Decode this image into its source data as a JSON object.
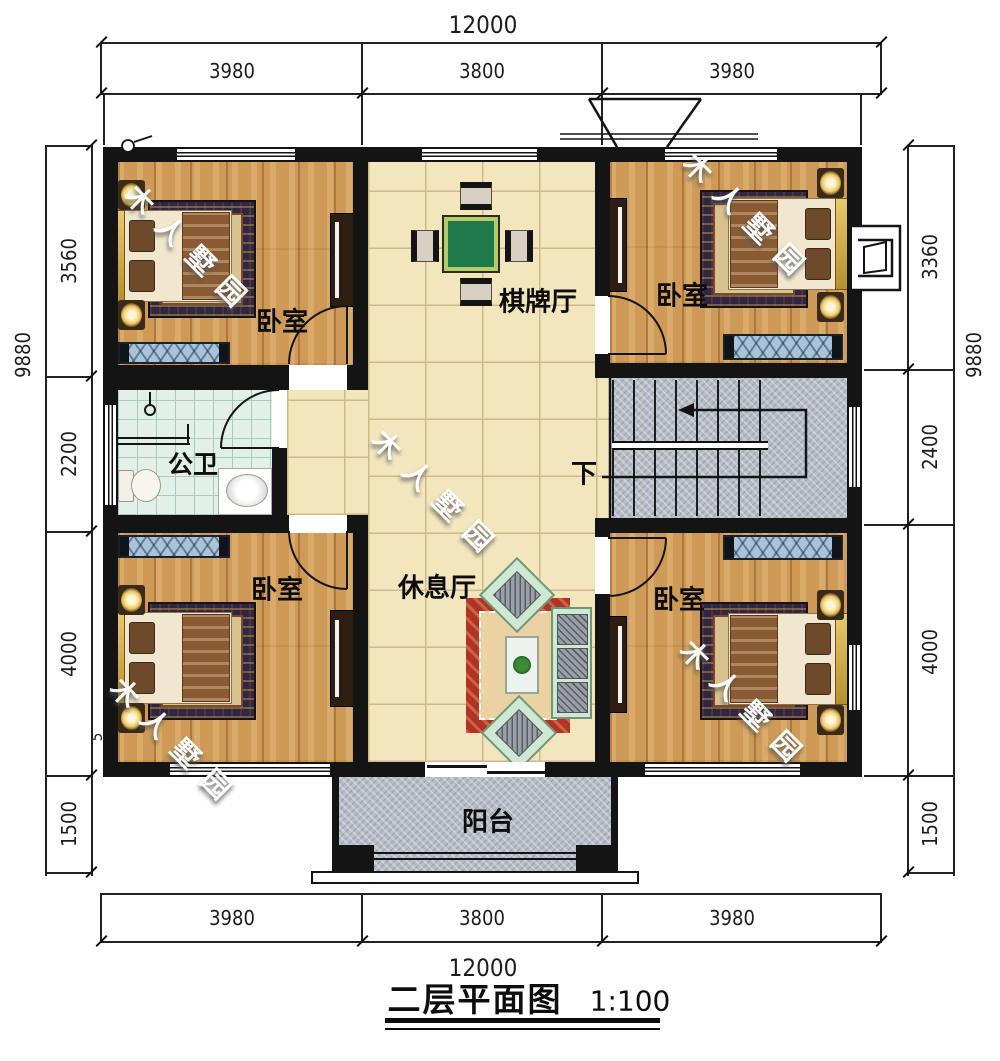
{
  "title": {
    "text": "二层平面图",
    "scale": "1:100"
  },
  "dimensions": {
    "top": {
      "total": "12000",
      "segments": [
        "3980",
        "3800",
        "3980"
      ]
    },
    "bottom": {
      "total": "12000",
      "segments": [
        "3980",
        "3800",
        "3980"
      ]
    },
    "left": {
      "total": "9880",
      "segments": [
        "3560",
        "2200",
        "4000",
        "1500"
      ]
    },
    "right": {
      "total": "9880",
      "segments": [
        "3360",
        "2400",
        "4000",
        "1500"
      ]
    },
    "left_extra": "5"
  },
  "rooms": {
    "bedroom_tl": "卧室",
    "chess_hall": "棋牌厅",
    "bedroom_tr": "卧室",
    "bathroom": "公卫",
    "stairs_down": "下",
    "bedroom_bl": "卧室",
    "lounge": "休息厅",
    "bedroom_br": "卧室",
    "balcony": "阳台"
  },
  "watermark": "木人墅园",
  "colors": {
    "wall": "#141414",
    "wood_floor": "#cf9a57",
    "tile_floor": "#f3e6bd",
    "bath_floor": "#e2f0e9",
    "granite": "#b8bec7",
    "mahjong_table": "#1e7a4a",
    "rug_red": "#b23228",
    "sofa_mint": "#cfe8d2",
    "bench_blue": "#a9c3d8"
  }
}
